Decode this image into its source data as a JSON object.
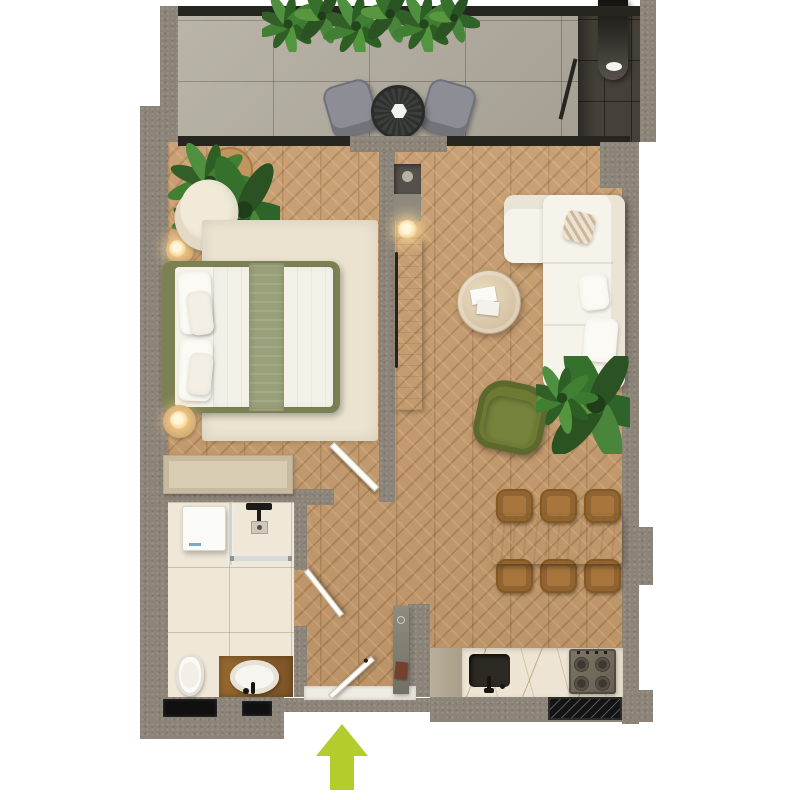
{
  "plan": {
    "title": "apartment-floor-plan-top-view",
    "canvas": {
      "width": 800,
      "height": 800,
      "background": "#ffffff"
    },
    "entrance": {
      "symbol": "arrow-up",
      "color": "#b5cc2e",
      "location": "bottom-center"
    }
  },
  "colors": {
    "wall": "#8c8478",
    "glass": "#26251f",
    "balconyTile": "#b2ac9f",
    "wood": "#c69b6c",
    "bathTile": "#efe7d7",
    "marble": "#ede4d3",
    "rug": "#ebe3cf",
    "bedFrame": "#7c8154",
    "sageThrow": "#9aa17a",
    "fabricWhite": "#f6f3ea",
    "creamChair": "#efe8d7",
    "greenChair": "#6d7a34",
    "diningChair": "#a8763c",
    "diningTable": "#ccb288",
    "dresser": "#d8ccb3",
    "vanityWood": "#8a5c2f",
    "stove": "#756d5f",
    "sinkDark": "#2d2923",
    "arrow": "#b5cc2e",
    "plantGreen": "#417f33"
  },
  "rooms": [
    {
      "name": "balcony",
      "items": [
        "hanging-plants",
        "outdoor-chair-left",
        "round-bistro-table",
        "outdoor-chair-right",
        "drain-pipe-niche",
        "glass-sliding-wall"
      ]
    },
    {
      "name": "bedroom",
      "items": [
        "corner-plants",
        "wood-stool",
        "cream-armchair",
        "floor-lamp",
        "area-rug",
        "double-bed",
        "pillows",
        "sage-throw-runner",
        "nightstand-lamp",
        "dresser",
        "interior-door"
      ]
    },
    {
      "name": "bathroom",
      "items": [
        "washing-machine",
        "walk-in-shower",
        "shower-head",
        "floor-drain",
        "glass-screen",
        "toilet",
        "wood-vanity",
        "vessel-sink",
        "black-faucet",
        "interior-door",
        "wall-windows-x2"
      ]
    },
    {
      "name": "hallway",
      "items": [
        "entrance-door",
        "threshold",
        "console-shelf",
        "decor-book"
      ]
    },
    {
      "name": "living-room",
      "items": [
        "wardrobe-column",
        "display-niche",
        "accent-lamp",
        "l-shaped-white-sofa",
        "throw-pillows-x3",
        "round-coffee-table",
        "magazines",
        "green-armchair",
        "floor-plants",
        "dining-table",
        "dining-chairs-x6"
      ]
    },
    {
      "name": "kitchen",
      "items": [
        "tall-cabinet",
        "marble-counter-run",
        "undermount-sink",
        "black-faucet",
        "gas-cooktop-4-burner",
        "hatched-vent-window"
      ]
    }
  ]
}
